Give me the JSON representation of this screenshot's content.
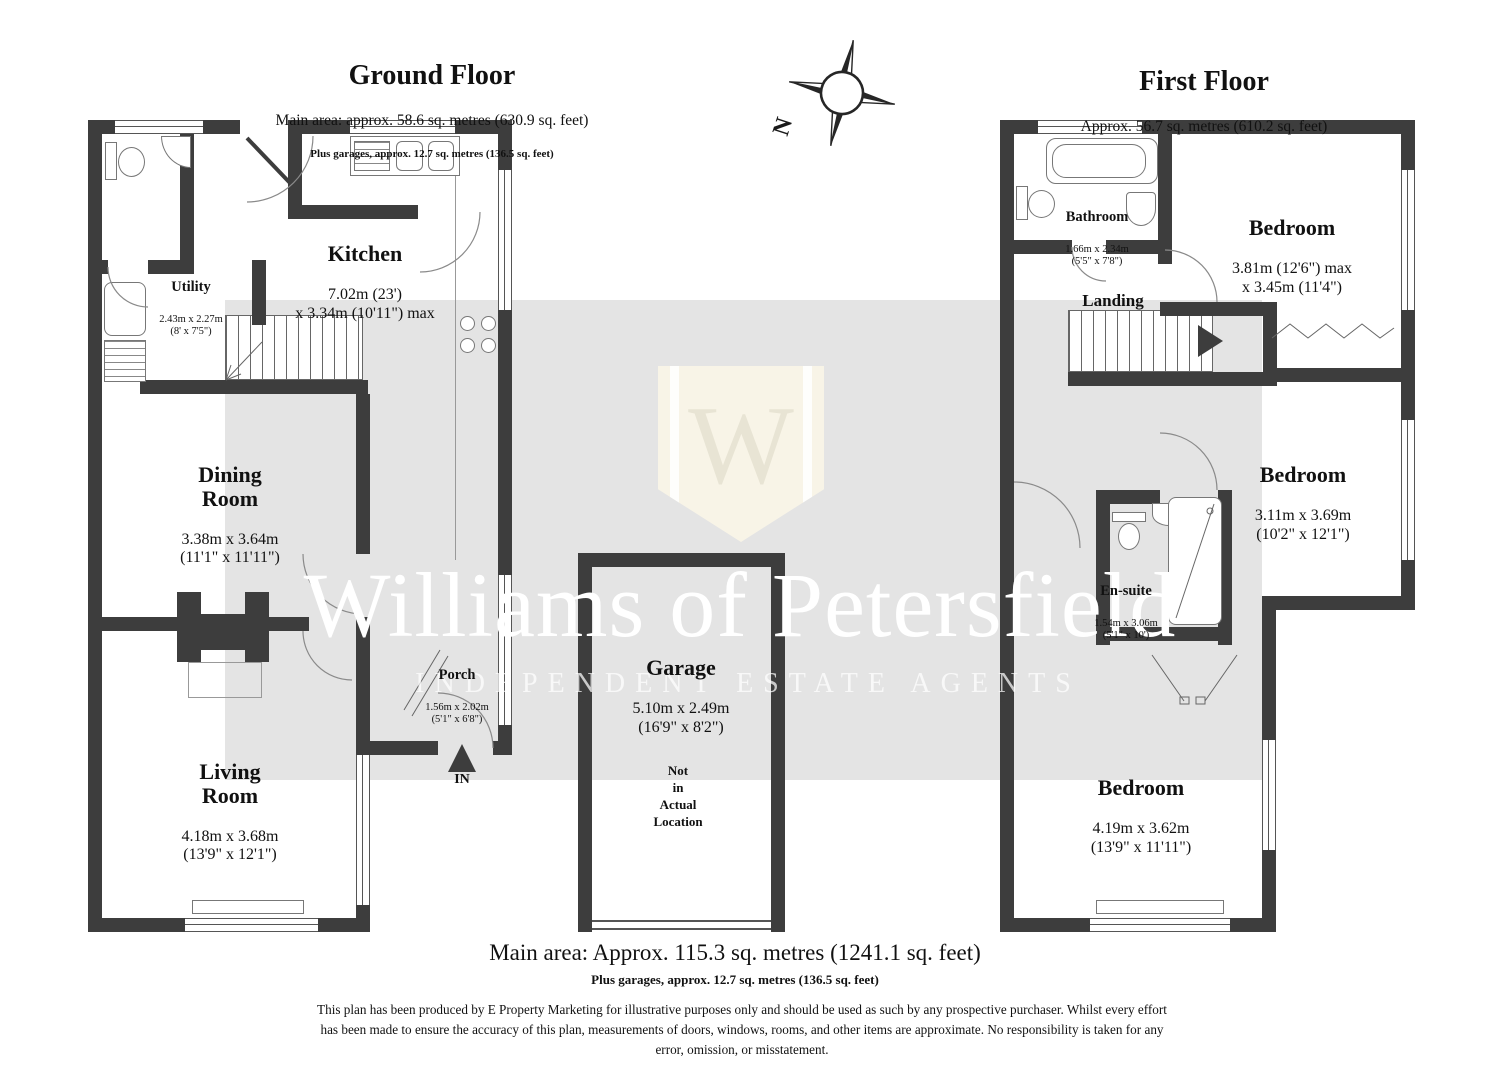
{
  "ground_floor": {
    "title": "Ground Floor",
    "area_line": "Main area: approx. 58.6 sq. metres (630.9 sq. feet)",
    "garage_line": "Plus garages, approx. 12.7 sq. metres (136.5 sq. feet)",
    "rooms": {
      "kitchen": {
        "name": "Kitchen",
        "dims": "7.02m (23')\nx 3.34m (10'11\") max"
      },
      "utility": {
        "name": "Utility",
        "dims": "2.43m x 2.27m\n(8' x 7'5\")"
      },
      "dining": {
        "name": "Dining\nRoom",
        "dims": "3.38m x 3.64m\n(11'1\" x 11'11\")"
      },
      "living": {
        "name": "Living\nRoom",
        "dims": "4.18m x 3.68m\n(13'9\" x 12'1\")"
      },
      "porch": {
        "name": "Porch",
        "dims": "1.56m x 2.02m\n(5'1\" x 6'8\")"
      },
      "entrance_label": "IN"
    }
  },
  "first_floor": {
    "title": "First Floor",
    "area_line": "Approx. 56.7 sq. metres (610.2 sq. feet)",
    "rooms": {
      "bathroom": {
        "name": "Bathroom",
        "dims": "1.66m x 2.34m\n(5'5\" x 7'8\")"
      },
      "landing": {
        "name": "Landing"
      },
      "bedroom1": {
        "name": "Bedroom",
        "dims": "3.81m (12'6\") max\nx 3.45m (11'4\")"
      },
      "bedroom2": {
        "name": "Bedroom",
        "dims": "3.11m x 3.69m\n(10'2\" x 12'1\")"
      },
      "ensuite": {
        "name": "En-suite",
        "dims": "1.54m x 3.06m\n(5'1\" x 10')"
      },
      "bedroom3": {
        "name": "Bedroom",
        "dims": "4.19m x 3.62m\n(13'9\" x 11'11\")"
      }
    }
  },
  "garage": {
    "name": "Garage",
    "dims": "5.10m x 2.49m\n(16'9\" x 8'2\")",
    "note": "Not\nin\nActual\nLocation"
  },
  "footer": {
    "main_area": "Main area: Approx. 115.3 sq. metres (1241.1 sq. feet)",
    "garage_area": "Plus garages, approx. 12.7 sq. metres (136.5 sq. feet)",
    "disclaimer": "This plan has been produced by E Property Marketing for illustrative purposes only and should be used as such by any prospective purchaser. Whilst every effort\nhas been made to ensure the accuracy of this plan, measurements of doors, windows, rooms, and other items are approximate. No responsibility is taken for any\nerror, omission, or misstatement."
  },
  "watermark": {
    "brand": "Williams of Petersfield",
    "tagline": "INDEPENDENT ESTATE AGENTS",
    "monogram": "W"
  },
  "compass": {
    "north_label": "N"
  },
  "colors": {
    "wall": "#3d3d3d",
    "band": "#e4e4e4",
    "shield": "#f8f4e7"
  }
}
